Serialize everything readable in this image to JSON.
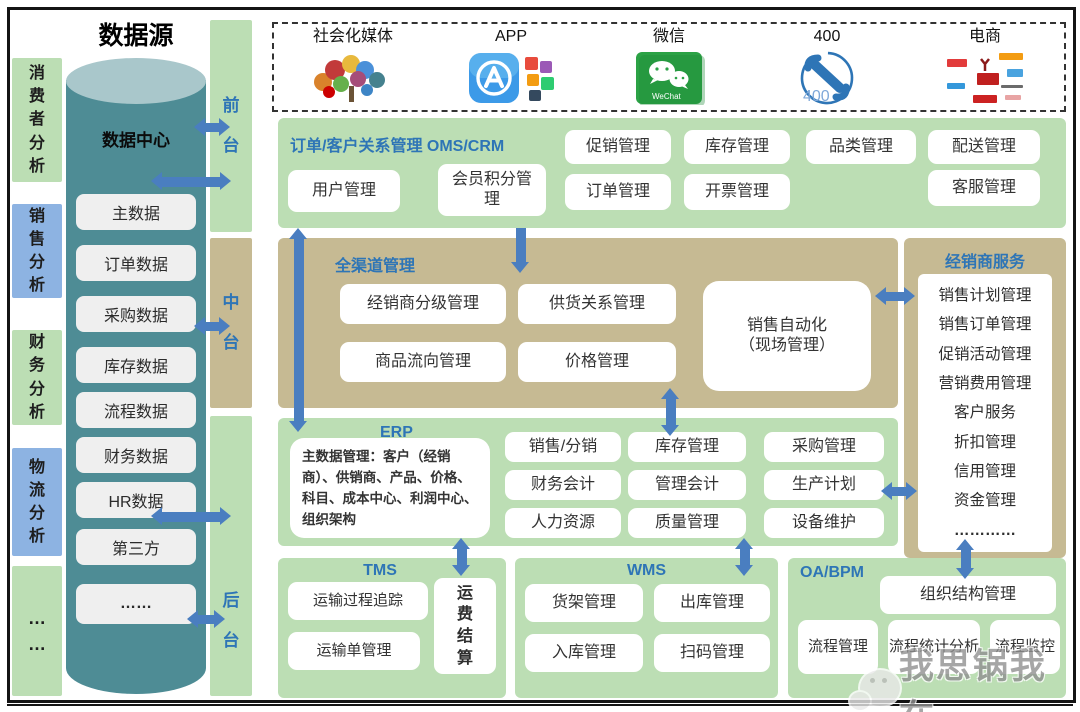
{
  "page": {
    "title": "数据源"
  },
  "colors": {
    "arrow_blue": "#4A7EC0",
    "heading_blue": "#2E75B6",
    "section_green": "#BCDEB4",
    "section_tan": "#C6BA93",
    "analysis_blue": "#8DB3E2",
    "cylinder_teal": "#4E8C95"
  },
  "sidebar": {
    "items": [
      {
        "label": "消费者分析"
      },
      {
        "label": "销售分析"
      },
      {
        "label": "财务分析"
      },
      {
        "label": "物流分析"
      },
      {
        "label": "…\n…"
      }
    ]
  },
  "cylinder": {
    "title": "数据中心",
    "items": [
      "主数据",
      "订单数据",
      "采购数据",
      "库存数据",
      "流程数据",
      "财务数据",
      "HR数据",
      "第三方",
      "……"
    ]
  },
  "tiers": {
    "front": "前台",
    "middle": "中台",
    "back": "后台"
  },
  "channels": {
    "items": [
      {
        "label": "社会化媒体",
        "icon": "social-media-icon"
      },
      {
        "label": "APP",
        "icon": "app-store-icon"
      },
      {
        "label": "微信",
        "icon": "wechat-icon"
      },
      {
        "label": "400",
        "icon": "phone-400-icon"
      },
      {
        "label": "电商",
        "icon": "ecommerce-logos-icon"
      }
    ],
    "wechat_caption": "WeChat",
    "phone_number": "400"
  },
  "front_office": {
    "title": "订单/客户关系管理  OMS/CRM",
    "row1": [
      "促销管理",
      "库存管理",
      "品类管理",
      "配送管理"
    ],
    "row2": [
      "用户管理",
      "会员积分管理",
      "订单管理",
      "开票管理",
      "客服管理"
    ]
  },
  "omni_channel": {
    "title": "全渠道管理",
    "boxes": [
      "经销商分级管理",
      "供货关系管理",
      "商品流向管理",
      "价格管理"
    ],
    "sales_automation": "销售自动化\n（现场管理）"
  },
  "dealer_service": {
    "title": "经销商服务",
    "items": [
      "销售计划管理",
      "销售订单管理",
      "促销活动管理",
      "营销费用管理",
      "客户服务",
      "折扣管理",
      "信用管理",
      "资金管理",
      "…………"
    ]
  },
  "erp": {
    "title": "ERP",
    "master_data": "主数据管理：客户（经销商）、供销商、产品、价格、科目、成本中心、利润中心、组织架构",
    "grid": [
      "销售/分销",
      "库存管理",
      "采购管理",
      "财务会计",
      "管理会计",
      "生产计划",
      "人力资源",
      "质量管理",
      "设备维护"
    ]
  },
  "tms": {
    "title": "TMS",
    "boxes": [
      "运输过程追踪",
      "运输单管理"
    ],
    "vertical_box": "运费结算"
  },
  "wms": {
    "title": "WMS",
    "boxes": [
      "货架管理",
      "出库管理",
      "入库管理",
      "扫码管理"
    ]
  },
  "oa_bpm": {
    "title": "OA/BPM",
    "top_box": "组织结构管理",
    "boxes": [
      "流程管理",
      "流程统计分析",
      "流程监控"
    ]
  },
  "watermark": {
    "text": "我思锅我在"
  }
}
